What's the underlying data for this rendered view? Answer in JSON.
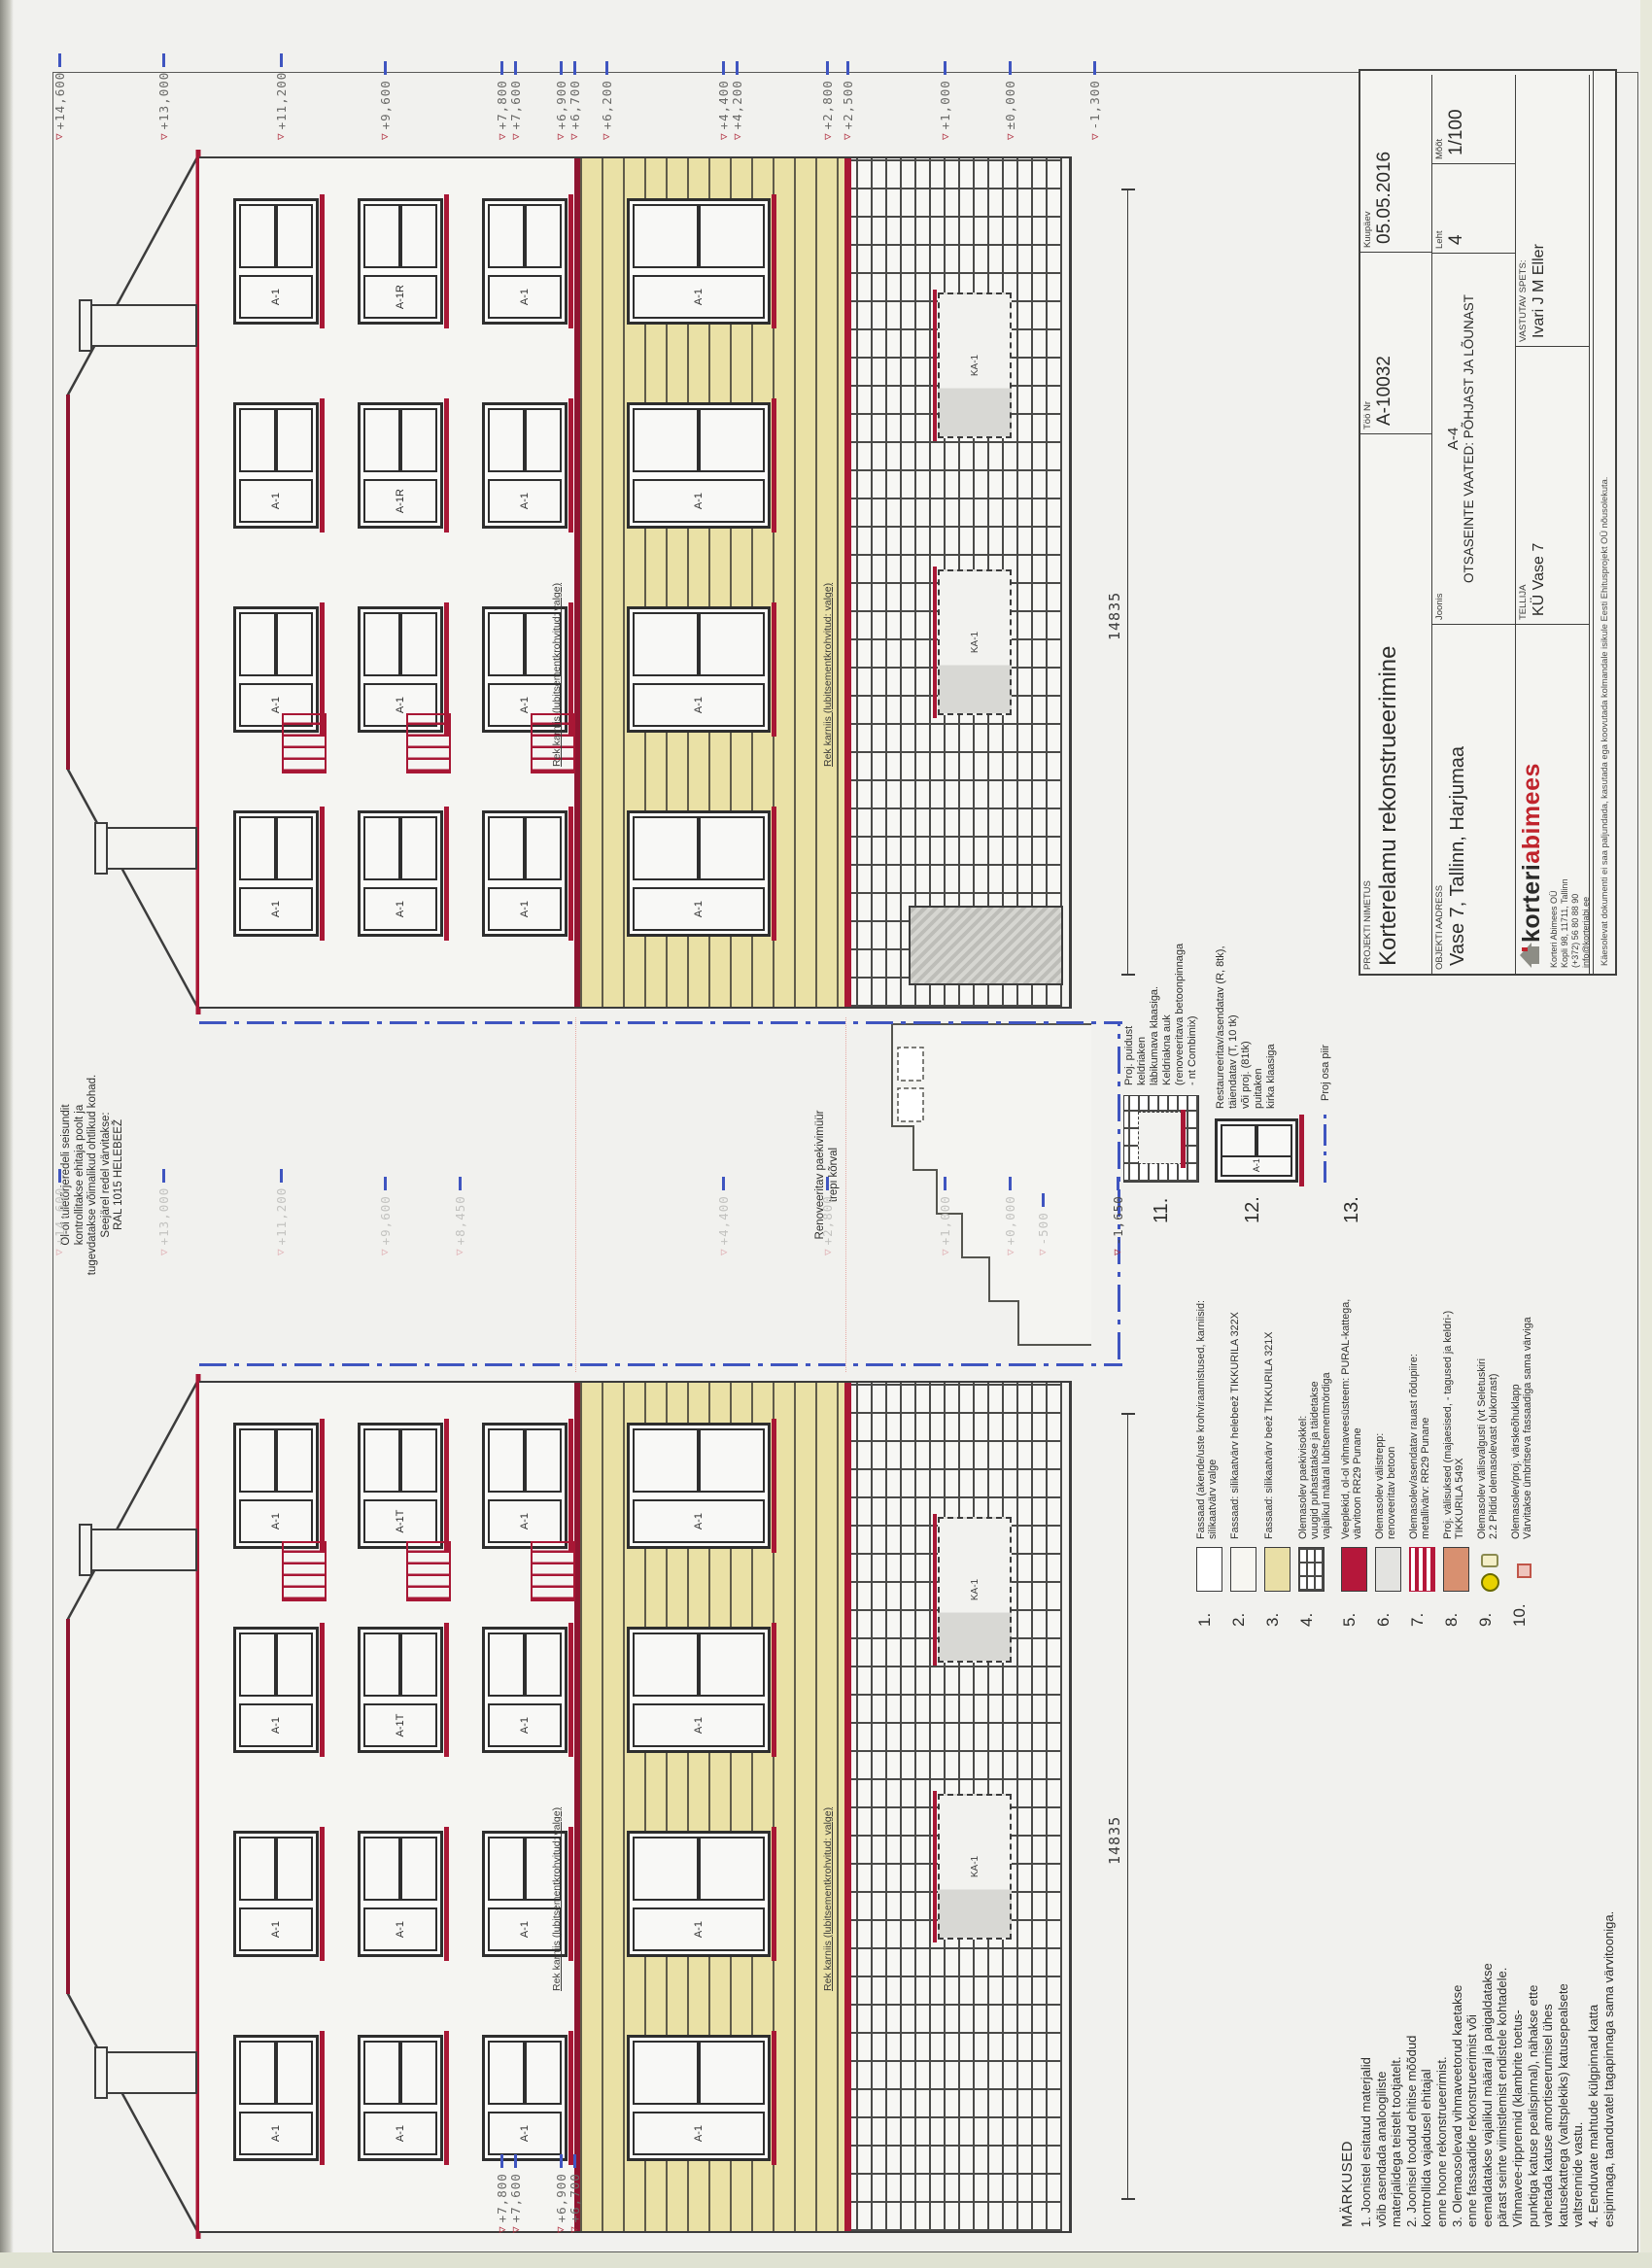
{
  "titleblock": {
    "work_no_label": "Töö Nr",
    "work_no": "A-10032",
    "date_label": "Kuupäev",
    "date": "05.05.2016",
    "sheet_label": "Leht",
    "sheet": "4",
    "scale_label": "Mõõt",
    "scale": "1/100",
    "project_label": "PROJEKTI NIMETUS",
    "project": "Korterelamu rekonstrueerimine",
    "address_label": "OBJEKTI AADRESS",
    "address": "Vase 7, Tallinn, Harjumaa",
    "drawing_label": "Joonis",
    "drawing_code": "A-4",
    "drawing_title": "OTSASEINTE VAATED: PÕHJAST JA LÕUNAST",
    "client_label": "TELLIJA",
    "client": "KÜ Vase 7",
    "spec_label": "VASTUTAV SPETS:",
    "spec": "Ivari J M Eller",
    "logo_black": "korteri",
    "logo_red": "abimees",
    "company_lines": [
      "Korteri Abimees OÜ",
      "Kopli 98, 11711, Tallinn",
      "(+372) 56 80 88 90",
      "info@korteriabi.ee",
      "Reg-kood: 12199567",
      "MTR Reg nr: EEP003218"
    ],
    "disclaimer": "Käesolevat dokumenti ei saa paljundada, kasutada ega koovutada kolmandale isikule Eesti Ehitusprojekt OÜ nõusolekuta."
  },
  "notes": {
    "title": "MÄRKUSED",
    "lines": [
      "1. Joonistel esitatud materjalid",
      "võib asendada analoogiliste",
      "materjalidega teistelt tootjatelt.",
      "2. Joonisel toodud ehitise mõõdud",
      "kontrollida vajadusel ehitajal",
      "enne hoone rekonstrueerimist.",
      "3. Olemaosolevad vihmaveetorud kaetakse",
      "enne fassaadide rekonstrueerimist või",
      "eemaldatakse vajalikul määral ja paigaldatakse",
      "pärast seinte viimistlemist endistele kohtadele.",
      "Vihmavee-ripprennid (klambrite toetus-",
      "punktiga katuse pealispinnal), nähakse ette",
      "vahetada katuse amortiseerumisel ühes",
      "katusekattega (valtsplekiks) katusepealsete",
      "valtsrennide vastu.",
      "4. Eenduvate mahtude külgpinnad katta",
      "esipinnaga, taanduvatel tagapinnaga sama värvitooniga."
    ]
  },
  "ladder_note": {
    "lines": [
      "Ol-ol tuletõrjeredeli seisundit",
      "kontrollitakse ehitaja poolt ja",
      "tugevdatakse võimalikud ohtlikud kohad.",
      "Seejärel redel värvitakse:",
      "RAL 1015 HELEBEEŽ"
    ]
  },
  "legend": [
    {
      "no": "1.",
      "swatch": {
        "type": "color",
        "color": "#ffffff"
      },
      "lines": [
        "Fassaad (akende/uste krohviraamistused, karniisid:",
        "silikaatvärv valge"
      ]
    },
    {
      "no": "2.",
      "swatch": {
        "type": "color",
        "color": "#f7f6f1"
      },
      "lines": [
        "Fassaad: silikaatvärv helebeež TIKKURILA 322X"
      ]
    },
    {
      "no": "3.",
      "swatch": {
        "type": "color",
        "color": "#e9dfa6"
      },
      "lines": [
        "Fassaad: silikaatvärv beež TIKKURILA 321X"
      ]
    },
    {
      "no": "4.",
      "swatch": {
        "type": "brick"
      },
      "lines": [
        "Olemasolev paekivisokkel:",
        "vuugid puhastatakse ja täidetakse",
        "vajalikul määral lubitsementmördiga"
      ]
    },
    {
      "no": "5.",
      "swatch": {
        "type": "color",
        "color": "#b5173a"
      },
      "lines": [
        "Veeplekid, ol-ol vihmaveesüsteem: PURAL-kattega,",
        "värvitoon RR29 Punane"
      ]
    },
    {
      "no": "6.",
      "swatch": {
        "type": "color",
        "color": "#e3e3e0"
      },
      "lines": [
        "Olemasolev välistrepp:",
        "renoveeritav betoon"
      ]
    },
    {
      "no": "7.",
      "swatch": {
        "type": "stripes"
      },
      "lines": [
        "Olemasolev/asendatav rauast rõdupiire:",
        "metallivärv: RR29 Punane"
      ]
    },
    {
      "no": "8.",
      "swatch": {
        "type": "color",
        "color": "#d89070"
      },
      "lines": [
        "Proj. välisuksed (majaesised, - tagused ja keldri-)",
        "TIKKURILA 549X"
      ]
    },
    {
      "no": "9.",
      "swatch": {
        "type": "lamp"
      },
      "lines": [
        "Olemasolev välisvalgusti (vt Seletuskiri",
        "2.2 Pildid olemasolevast olukorrast)"
      ]
    },
    {
      "no": "10.",
      "swatch": {
        "type": "vent"
      },
      "lines": [
        "Olemasolev/proj. värskeõhuklapp",
        "Värvitakse ümbritseva fassaadiga sama värviga"
      ]
    }
  ],
  "legend_details": [
    {
      "no": "11.",
      "fig": "keldriaken-detail",
      "lines": [
        "Proj. puidust",
        "keldriaken",
        "läbikumava klaasiga.",
        "Keldriakna auk",
        "(renoveeritava betoonpinnaga",
        "- nt Combimix)"
      ]
    },
    {
      "no": "12.",
      "fig": "puitaken-detail",
      "window_label": "A-1",
      "lines": [
        "Restaureeritav/asendatav (R, 8tk),",
        "täiendatav (T, 10 tk)",
        "või proj. (81tk)",
        "puitaken",
        "kirka klaasiga"
      ]
    },
    {
      "no": "13.",
      "fig": "dashdot-line",
      "lines": [
        "Proj osa piir"
      ]
    }
  ],
  "labels": {
    "cornice": "Rek karniis (lubitsementkrohvitud: valge)",
    "railing": "Rek. / koopiaga asend. rõdupiire (RR29 Punane)",
    "paekivi": [
      "Renoveeritav paekivimüür",
      "trepi kõrval"
    ],
    "dimension": "14835",
    "basement_window": "KA-1"
  },
  "levels": {
    "right": [
      {
        "t": "+14,600",
        "v": 14600
      },
      {
        "t": "+13,000",
        "v": 13000
      },
      {
        "t": "+11,200",
        "v": 11200
      },
      {
        "t": "+9,600",
        "v": 9600
      },
      {
        "t": "+7,800",
        "v": 7800
      },
      {
        "t": "+7,600",
        "v": 7600
      },
      {
        "t": "+6,900",
        "v": 6900
      },
      {
        "t": "+6,700",
        "v": 6700
      },
      {
        "t": "+6,200",
        "v": 6200
      },
      {
        "t": "+4,400",
        "v": 4400
      },
      {
        "t": "+4,200",
        "v": 4200
      },
      {
        "t": "+2,800",
        "v": 2800
      },
      {
        "t": "+2,500",
        "v": 2500
      },
      {
        "t": "+1,000",
        "v": 1000
      },
      {
        "t": "±0,000",
        "v": 0
      },
      {
        "t": "-1,300",
        "v": -1300
      }
    ],
    "mid": [
      {
        "t": "+14,600",
        "v": 14600
      },
      {
        "t": "+13,000",
        "v": 13000
      },
      {
        "t": "+11,200",
        "v": 11200
      },
      {
        "t": "+9,600",
        "v": 9600
      },
      {
        "t": "+8,450",
        "v": 8450
      },
      {
        "t": "+4,400",
        "v": 4400
      },
      {
        "t": "+2,800",
        "v": 2800
      },
      {
        "t": "+1,000",
        "v": 1000
      },
      {
        "t": "+0,000",
        "v": 0
      },
      {
        "t": "-500",
        "v": -500
      },
      {
        "t": "-1,650",
        "v": -1650,
        "dark": true
      }
    ],
    "left_group": [
      {
        "t": "+7,800",
        "v": 7800
      },
      {
        "t": "+7,600",
        "v": 7600
      },
      {
        "t": "+6,900",
        "v": 6900
      },
      {
        "t": "+6,700",
        "v": 6700
      }
    ]
  },
  "elevations": {
    "left": {
      "name": "vaade-pohjast",
      "rows": [
        [
          "A-1",
          "A-1",
          "A-1",
          "A-1"
        ],
        [
          "A-1",
          "A-1",
          "A-1T",
          "A-1T"
        ],
        [
          "A-1",
          "A-1",
          "A-1",
          "A-1"
        ]
      ],
      "ground_row": [
        "A-1",
        "A-1",
        "A-1",
        "A-1"
      ],
      "basement": [
        "KA-1",
        "KA-1"
      ],
      "balcony_side": "right"
    },
    "right": {
      "name": "vaade-lounast",
      "rows": [
        [
          "A-1",
          "A-1",
          "A-1",
          "A-1"
        ],
        [
          "A-1",
          "A-1",
          "A-1R",
          "A-1R"
        ],
        [
          "A-1",
          "A-1",
          "A-1",
          "A-1"
        ]
      ],
      "ground_row": [
        "A-1",
        "A-1",
        "A-1",
        "A-1"
      ],
      "basement": [
        "KA-1",
        "KA-1"
      ],
      "balcony_side": "left"
    }
  },
  "colors": {
    "red": "#a81735",
    "dark_red": "#8f1430",
    "beige": "#eae1a6",
    "blue": "#3f55c0",
    "line": "#3c3c3c"
  }
}
